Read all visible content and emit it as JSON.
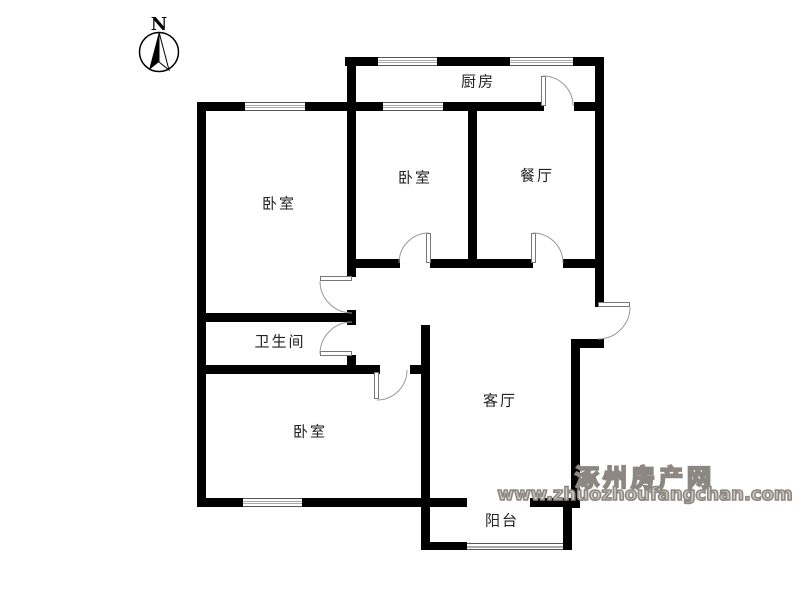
{
  "compass": {
    "label": "N"
  },
  "rooms": {
    "kitchen": "厨房",
    "bedroom_top_left": "卧室",
    "bedroom_middle": "卧室",
    "dining": "餐厅",
    "bathroom": "卫生间",
    "bedroom_bottom": "卧室",
    "living": "客厅",
    "balcony": "阳台"
  },
  "watermark": {
    "site_name": "涿州房产网",
    "site_url": "www.zhuozhoufangchan.com"
  },
  "colors": {
    "wall": "#000000",
    "door_arc": "#999999",
    "watermark": "#8d8781"
  }
}
